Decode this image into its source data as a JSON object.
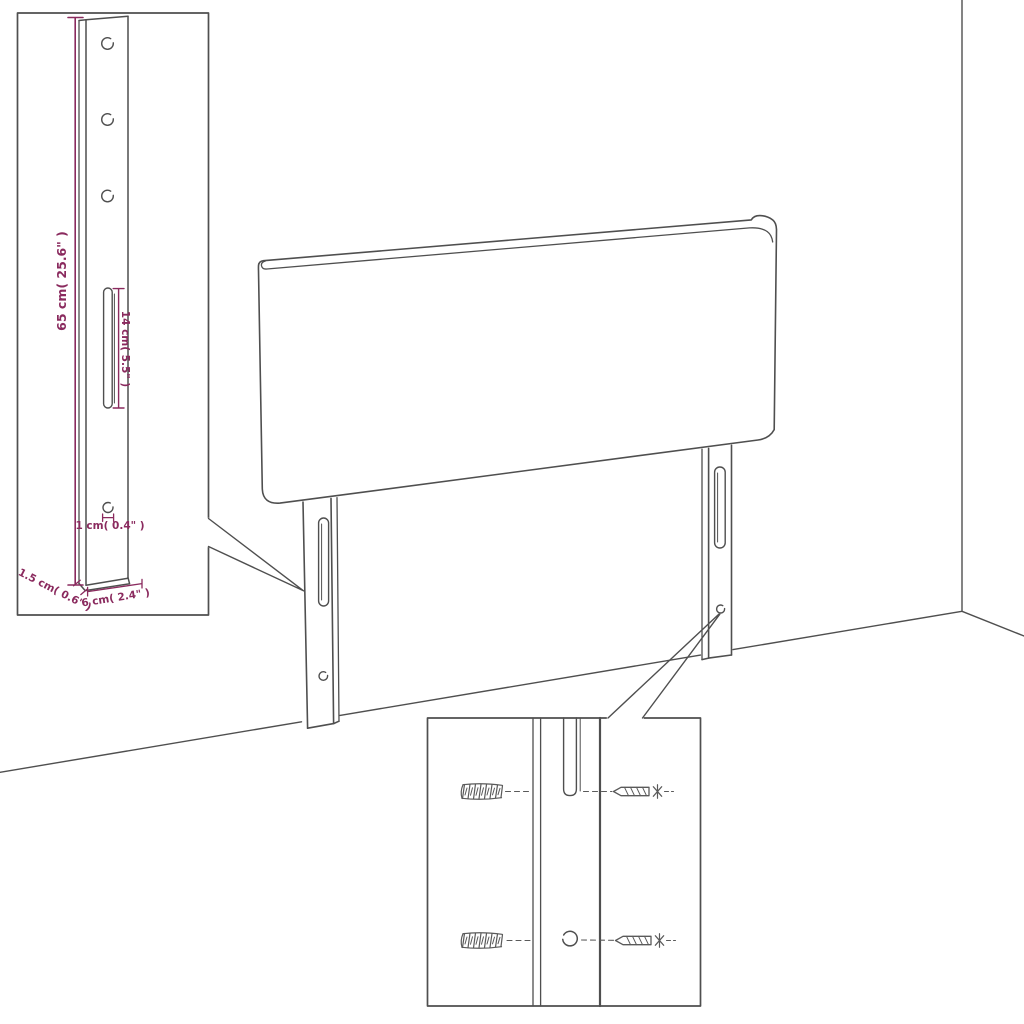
{
  "colors": {
    "line": "#4f4f4f",
    "thin_line": "#6a6a6a",
    "dimension": "#8a2a5e",
    "background": "#ffffff"
  },
  "inset_bracket": {
    "height_label": "65 cm( 25.6\" )",
    "slot_label": "14 cm( 5.5\" )",
    "hole_label": "1 cm( 0.4\" )",
    "thickness_label": "1.5 cm( 0.6\" )",
    "width_label": "6 cm( 2.4\" )"
  }
}
